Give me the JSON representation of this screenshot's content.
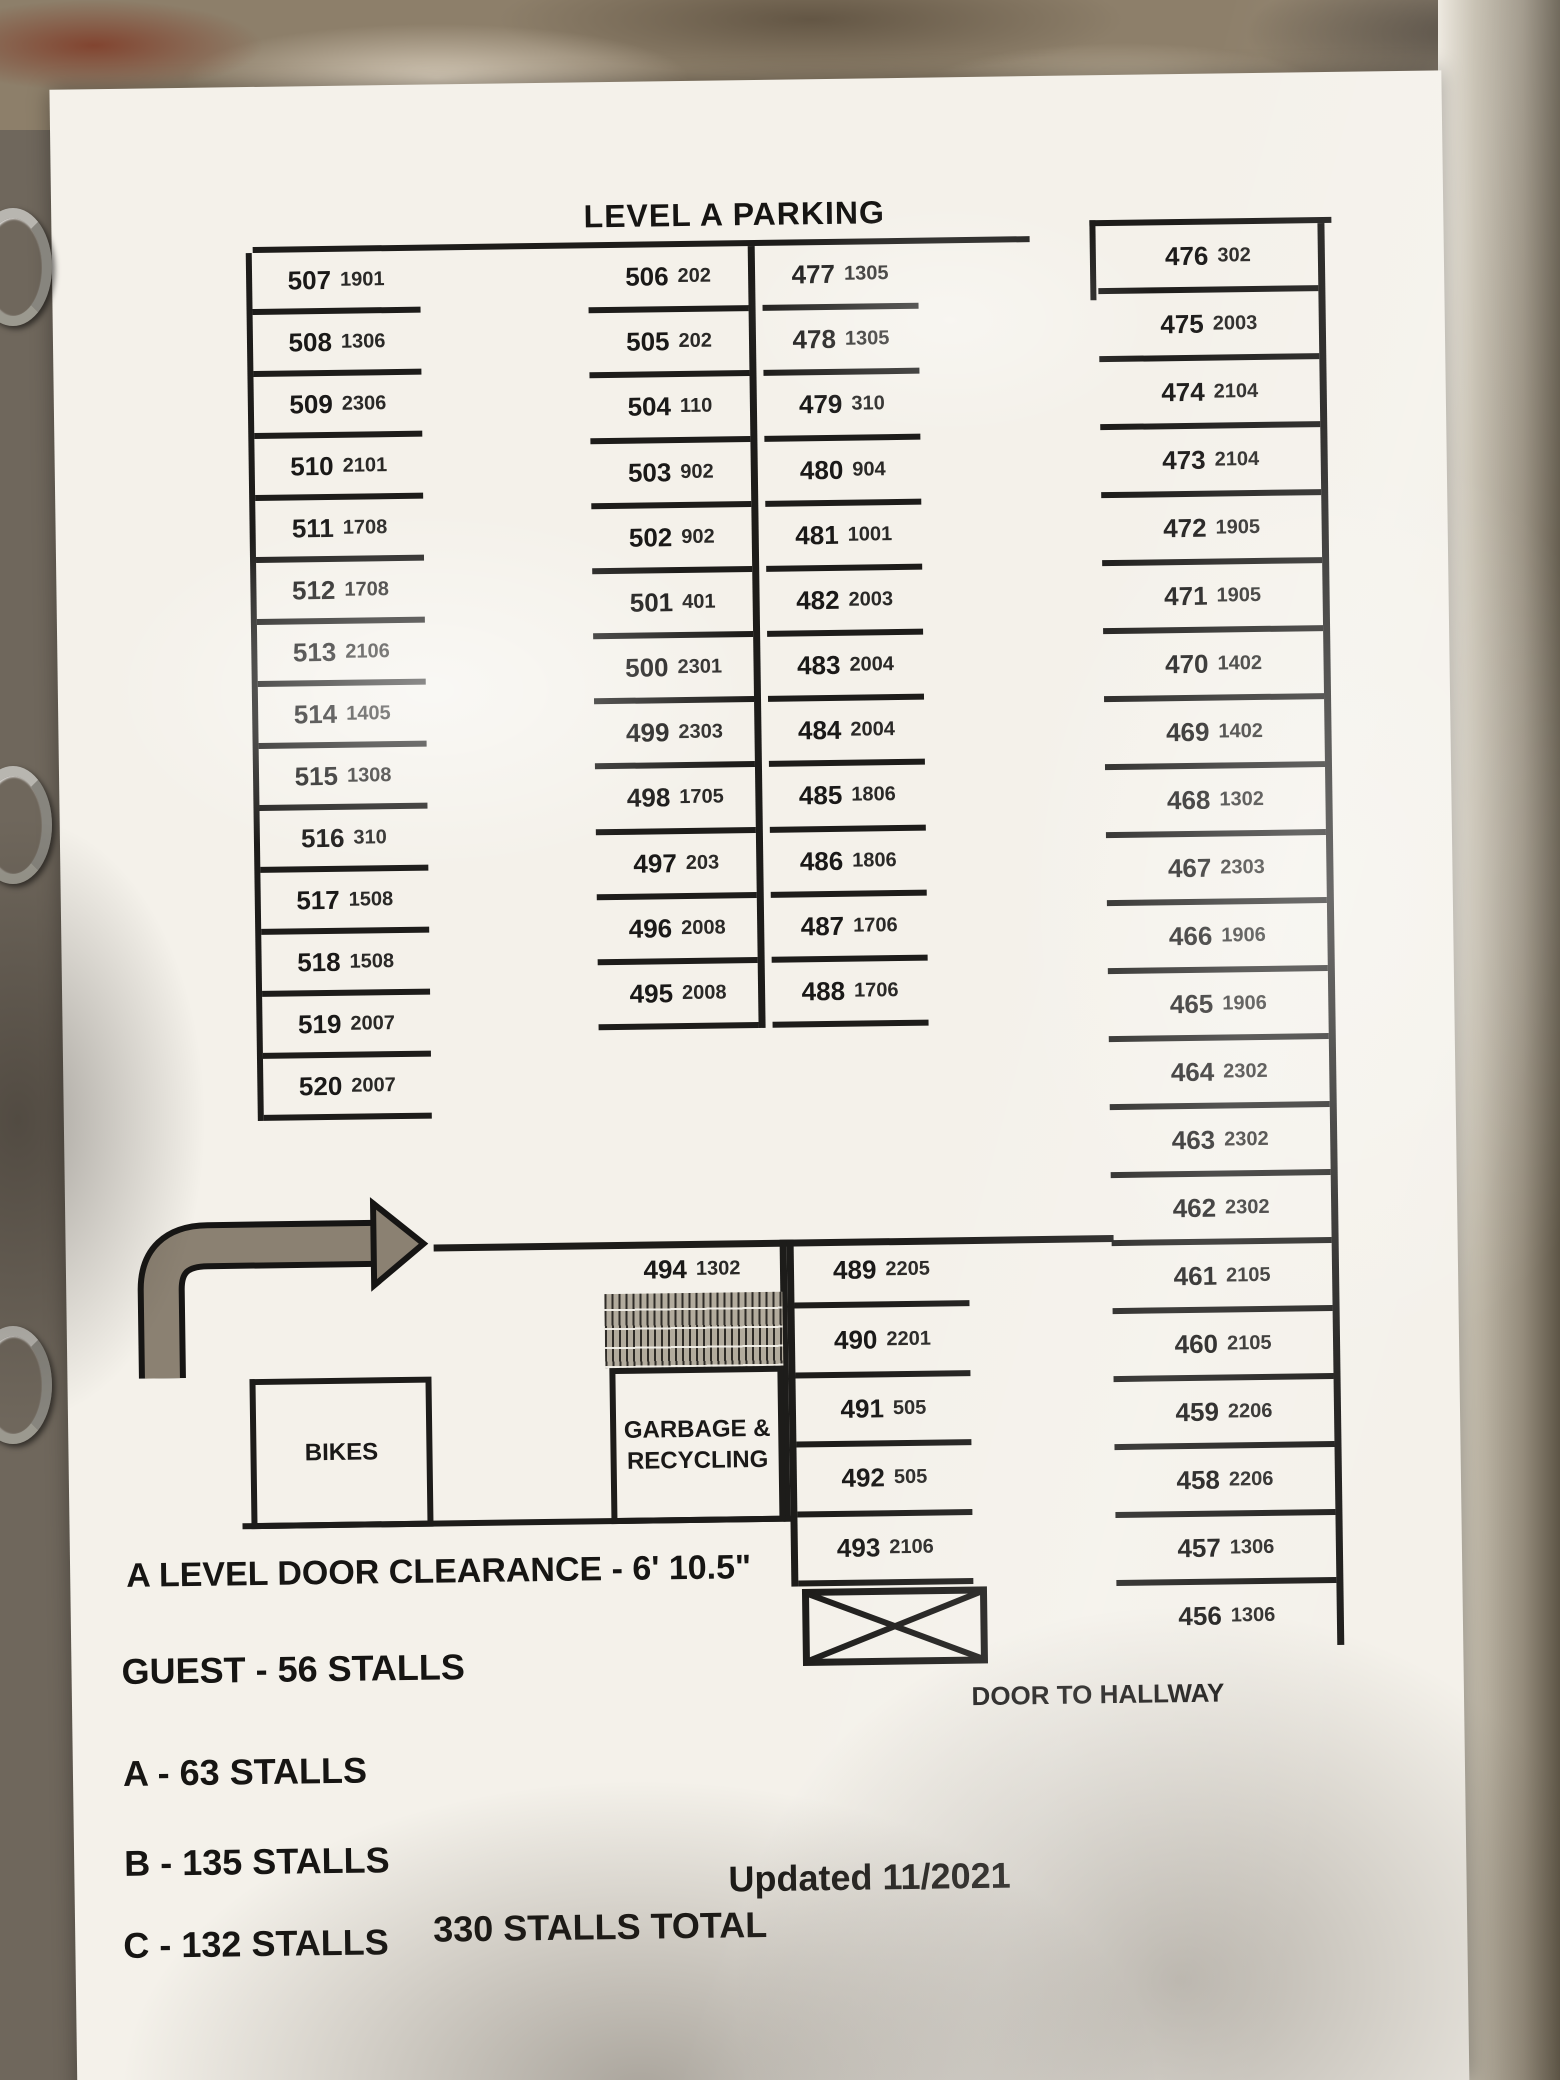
{
  "title": "LEVEL A PARKING",
  "columns": {
    "left": [
      {
        "n": "507",
        "u": "1901"
      },
      {
        "n": "508",
        "u": "1306"
      },
      {
        "n": "509",
        "u": "2306"
      },
      {
        "n": "510",
        "u": "2101"
      },
      {
        "n": "511",
        "u": "1708"
      },
      {
        "n": "512",
        "u": "1708"
      },
      {
        "n": "513",
        "u": "2106"
      },
      {
        "n": "514",
        "u": "1405"
      },
      {
        "n": "515",
        "u": "1308"
      },
      {
        "n": "516",
        "u": "310"
      },
      {
        "n": "517",
        "u": "1508"
      },
      {
        "n": "518",
        "u": "1508"
      },
      {
        "n": "519",
        "u": "2007"
      },
      {
        "n": "520",
        "u": "2007"
      }
    ],
    "mid_a": [
      {
        "n": "506",
        "u": "202"
      },
      {
        "n": "505",
        "u": "202"
      },
      {
        "n": "504",
        "u": "110"
      },
      {
        "n": "503",
        "u": "902"
      },
      {
        "n": "502",
        "u": "902"
      },
      {
        "n": "501",
        "u": "401"
      },
      {
        "n": "500",
        "u": "2301"
      },
      {
        "n": "499",
        "u": "2303"
      },
      {
        "n": "498",
        "u": "1705"
      },
      {
        "n": "497",
        "u": "203"
      },
      {
        "n": "496",
        "u": "2008"
      },
      {
        "n": "495",
        "u": "2008"
      }
    ],
    "mid_b": [
      {
        "n": "477",
        "u": "1305"
      },
      {
        "n": "478",
        "u": "1305"
      },
      {
        "n": "479",
        "u": "310"
      },
      {
        "n": "480",
        "u": "904"
      },
      {
        "n": "481",
        "u": "1001"
      },
      {
        "n": "482",
        "u": "2003"
      },
      {
        "n": "483",
        "u": "2004"
      },
      {
        "n": "484",
        "u": "2004"
      },
      {
        "n": "485",
        "u": "1806"
      },
      {
        "n": "486",
        "u": "1806"
      },
      {
        "n": "487",
        "u": "1706"
      },
      {
        "n": "488",
        "u": "1706"
      }
    ],
    "right": [
      {
        "n": "476",
        "u": "302"
      },
      {
        "n": "475",
        "u": "2003"
      },
      {
        "n": "474",
        "u": "2104"
      },
      {
        "n": "473",
        "u": "2104"
      },
      {
        "n": "472",
        "u": "1905"
      },
      {
        "n": "471",
        "u": "1905"
      },
      {
        "n": "470",
        "u": "1402"
      },
      {
        "n": "469",
        "u": "1402"
      },
      {
        "n": "468",
        "u": "1302"
      },
      {
        "n": "467",
        "u": "2303"
      },
      {
        "n": "466",
        "u": "1906"
      },
      {
        "n": "465",
        "u": "1906"
      },
      {
        "n": "464",
        "u": "2302"
      },
      {
        "n": "463",
        "u": "2302"
      },
      {
        "n": "462",
        "u": "2302"
      },
      {
        "n": "461",
        "u": "2105"
      },
      {
        "n": "460",
        "u": "2105"
      },
      {
        "n": "459",
        "u": "2206"
      },
      {
        "n": "458",
        "u": "2206"
      },
      {
        "n": "457",
        "u": "1306"
      },
      {
        "n": "456",
        "u": "1306"
      }
    ],
    "lower_mid": [
      {
        "n": "489",
        "u": "2205"
      },
      {
        "n": "490",
        "u": "2201"
      },
      {
        "n": "491",
        "u": "505"
      },
      {
        "n": "492",
        "u": "505"
      },
      {
        "n": "493",
        "u": "2106"
      }
    ]
  },
  "aisle_stall": {
    "n": "494",
    "u": "1302"
  },
  "labels": {
    "bikes": "BIKES",
    "garbage_line1": "GARBAGE &",
    "garbage_line2": "RECYCLING",
    "door_to_hallway": "DOOR TO HALLWAY"
  },
  "notes": {
    "door_clearance": "A LEVEL DOOR CLEARANCE - 6' 10.5\"",
    "guest": "GUEST - 56 STALLS",
    "level_a": "A - 63 STALLS",
    "level_b": "B - 135 STALLS",
    "level_c": "C - 132 STALLS",
    "total": "330 STALLS TOTAL",
    "updated": "Updated 11/2021"
  },
  "colors": {
    "ink": "#1d1c1a",
    "paper": "#f4f1ea",
    "arrow_gray": "#8b8172",
    "marble": "#8d7f6a"
  }
}
